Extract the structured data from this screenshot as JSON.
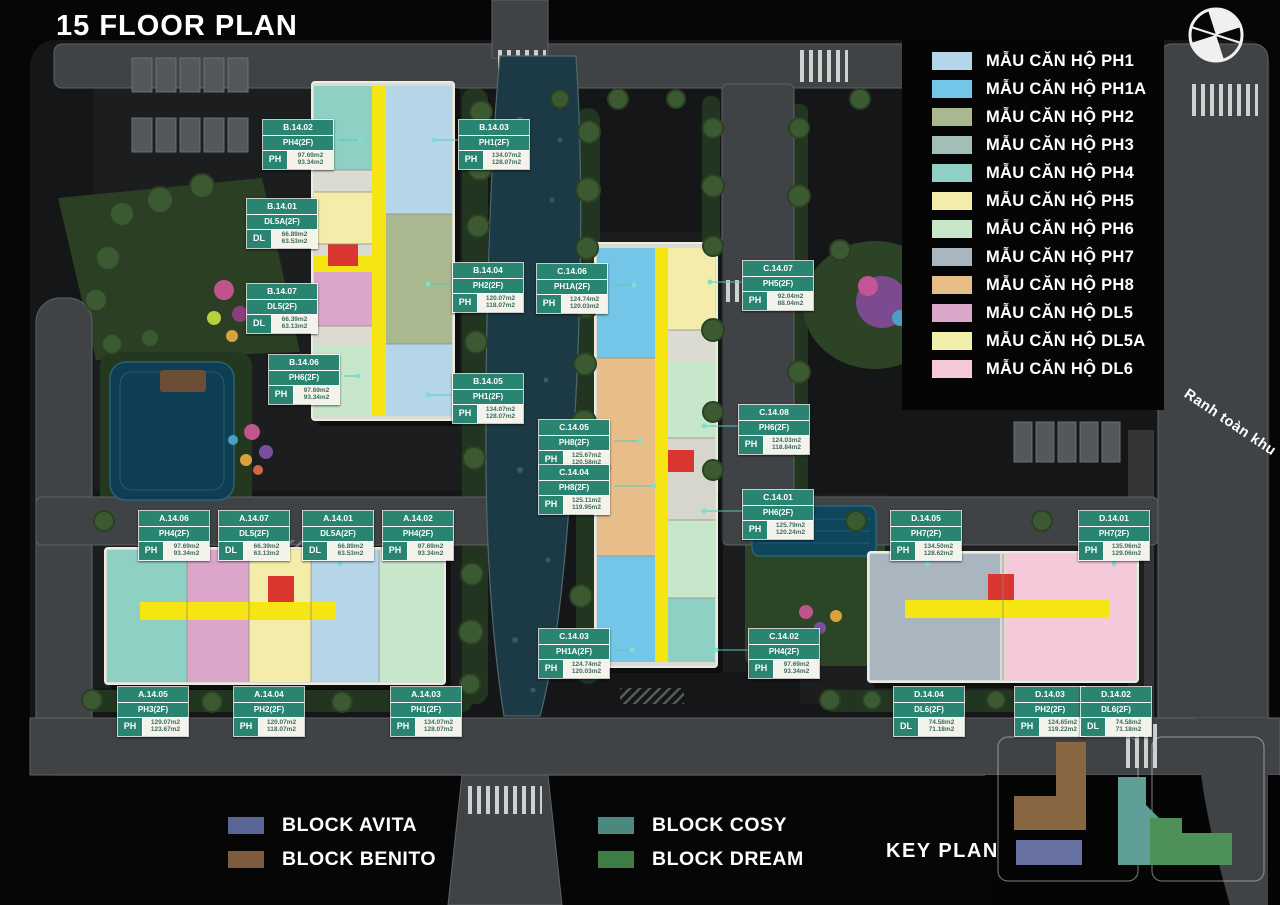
{
  "title": "15 FLOOR PLAN",
  "boundary_label": "Ranh toàn khu",
  "key_plan": {
    "label": "KEY PLAN"
  },
  "legend": {
    "items": [
      {
        "key": "PH1",
        "label": "MẪU CĂN HỘ PH1",
        "color": "#b5d6e8"
      },
      {
        "key": "PH1A",
        "label": "MẪU CĂN HỘ PH1A",
        "color": "#74c6e8"
      },
      {
        "key": "PH2",
        "label": "MẪU CĂN HỘ PH2",
        "color": "#a9b88e"
      },
      {
        "key": "PH3",
        "label": "MẪU CĂN HỘ PH3",
        "color": "#a3bdb9"
      },
      {
        "key": "PH4",
        "label": "MẪU CĂN HỘ PH4",
        "color": "#8fd0c5"
      },
      {
        "key": "PH5",
        "label": "MẪU CĂN HỘ PH5",
        "color": "#f3eda9"
      },
      {
        "key": "PH6",
        "label": "MẪU CĂN HỘ PH6",
        "color": "#c8e6c9"
      },
      {
        "key": "PH7",
        "label": "MẪU CĂN HỘ PH7",
        "color": "#a9b6bf"
      },
      {
        "key": "PH8",
        "label": "MẪU CĂN HỘ PH8",
        "color": "#e7be8a"
      },
      {
        "key": "DL5",
        "label": "MẪU CĂN HỘ DL5",
        "color": "#dca6ca"
      },
      {
        "key": "DL5A",
        "label": "MẪU CĂN HỘ DL5A",
        "color": "#f2efad"
      },
      {
        "key": "DL6",
        "label": "MẪU CĂN HỘ DL6",
        "color": "#f5c8da"
      }
    ]
  },
  "blocks_legend": [
    {
      "key": "avita",
      "label": "BLOCK AVITA",
      "color": "#5a6796",
      "group": "left"
    },
    {
      "key": "benito",
      "label": "BLOCK BENITO",
      "color": "#7d5b3c",
      "group": "left"
    },
    {
      "key": "cosy",
      "label": "BLOCK COSY",
      "color": "#4b8880",
      "group": "right"
    },
    {
      "key": "dream",
      "label": "BLOCK DREAM",
      "color": "#3d7d46",
      "group": "right"
    }
  ],
  "unit_labels": [
    {
      "code": "B.14.02",
      "type": "PH4(2F)",
      "cat": "PH",
      "area1": "97.69m2",
      "area2": "93.34m2",
      "x": 262,
      "y": 119
    },
    {
      "code": "B.14.03",
      "type": "PH1(2F)",
      "cat": "PH",
      "area1": "134.07m2",
      "area2": "128.07m2",
      "x": 458,
      "y": 119
    },
    {
      "code": "B.14.01",
      "type": "DL5A(2F)",
      "cat": "DL",
      "area1": "66.89m2",
      "area2": "63.53m2",
      "x": 246,
      "y": 198
    },
    {
      "code": "B.14.07",
      "type": "DL5(2F)",
      "cat": "DL",
      "area1": "66.39m2",
      "area2": "63.13m2",
      "x": 246,
      "y": 283
    },
    {
      "code": "B.14.04",
      "type": "PH2(2F)",
      "cat": "PH",
      "area1": "120.07m2",
      "area2": "118.07m2",
      "x": 452,
      "y": 262
    },
    {
      "code": "B.14.06",
      "type": "PH6(2F)",
      "cat": "PH",
      "area1": "97.69m2",
      "area2": "93.34m2",
      "x": 268,
      "y": 354
    },
    {
      "code": "B.14.05",
      "type": "PH1(2F)",
      "cat": "PH",
      "area1": "134.07m2",
      "area2": "128.07m2",
      "x": 452,
      "y": 373
    },
    {
      "code": "C.14.06",
      "type": "PH1A(2F)",
      "cat": "PH",
      "area1": "124.74m2",
      "area2": "120.03m2",
      "x": 536,
      "y": 263
    },
    {
      "code": "C.14.07",
      "type": "PH5(2F)",
      "cat": "PH",
      "area1": "92.04m2",
      "area2": "88.04m2",
      "x": 742,
      "y": 260
    },
    {
      "code": "C.14.05",
      "type": "PH8(2F)",
      "cat": "PH",
      "area1": "125.67m2",
      "area2": "120.58m2",
      "x": 538,
      "y": 419
    },
    {
      "code": "C.14.04",
      "type": "PH8(2F)",
      "cat": "PH",
      "area1": "125.11m2",
      "area2": "119.95m2",
      "x": 538,
      "y": 464
    },
    {
      "code": "C.14.08",
      "type": "PH6(2F)",
      "cat": "PH",
      "area1": "124.03m2",
      "area2": "118.84m2",
      "x": 738,
      "y": 404
    },
    {
      "code": "C.14.01",
      "type": "PH6(2F)",
      "cat": "PH",
      "area1": "125.79m2",
      "area2": "120.24m2",
      "x": 742,
      "y": 489
    },
    {
      "code": "C.14.03",
      "type": "PH1A(2F)",
      "cat": "PH",
      "area1": "124.74m2",
      "area2": "120.03m2",
      "x": 538,
      "y": 628
    },
    {
      "code": "C.14.02",
      "type": "PH4(2F)",
      "cat": "PH",
      "area1": "97.69m2",
      "area2": "93.34m2",
      "x": 748,
      "y": 628
    },
    {
      "code": "A.14.06",
      "type": "PH4(2F)",
      "cat": "PH",
      "area1": "97.69m2",
      "area2": "93.34m2",
      "x": 138,
      "y": 510
    },
    {
      "code": "A.14.07",
      "type": "DL5(2F)",
      "cat": "DL",
      "area1": "66.39m2",
      "area2": "63.13m2",
      "x": 218,
      "y": 510
    },
    {
      "code": "A.14.01",
      "type": "DL5A(2F)",
      "cat": "DL",
      "area1": "66.89m2",
      "area2": "63.53m2",
      "x": 302,
      "y": 510
    },
    {
      "code": "A.14.02",
      "type": "PH4(2F)",
      "cat": "PH",
      "area1": "97.69m2",
      "area2": "93.34m2",
      "x": 382,
      "y": 510
    },
    {
      "code": "A.14.05",
      "type": "PH3(2F)",
      "cat": "PH",
      "area1": "129.07m2",
      "area2": "123.67m2",
      "x": 117,
      "y": 686
    },
    {
      "code": "A.14.04",
      "type": "PH2(2F)",
      "cat": "PH",
      "area1": "120.07m2",
      "area2": "118.07m2",
      "x": 233,
      "y": 686
    },
    {
      "code": "A.14.03",
      "type": "PH1(2F)",
      "cat": "PH",
      "area1": "134.07m2",
      "area2": "128.07m2",
      "x": 390,
      "y": 686
    },
    {
      "code": "D.14.05",
      "type": "PH7(2F)",
      "cat": "PH",
      "area1": "134.50m2",
      "area2": "128.62m2",
      "x": 890,
      "y": 510
    },
    {
      "code": "D.14.01",
      "type": "PH7(2F)",
      "cat": "PH",
      "area1": "135.06m2",
      "area2": "129.06m2",
      "x": 1078,
      "y": 510
    },
    {
      "code": "D.14.04",
      "type": "DL6(2F)",
      "cat": "DL",
      "area1": "74.58m2",
      "area2": "71.18m2",
      "x": 893,
      "y": 686
    },
    {
      "code": "D.14.03",
      "type": "PH2(2F)",
      "cat": "PH",
      "area1": "124.65m2",
      "area2": "119.22m2",
      "x": 1014,
      "y": 686
    },
    {
      "code": "D.14.02",
      "type": "DL6(2F)",
      "cat": "DL",
      "area1": "74.58m2",
      "area2": "71.18m2",
      "x": 1080,
      "y": 686
    }
  ]
}
